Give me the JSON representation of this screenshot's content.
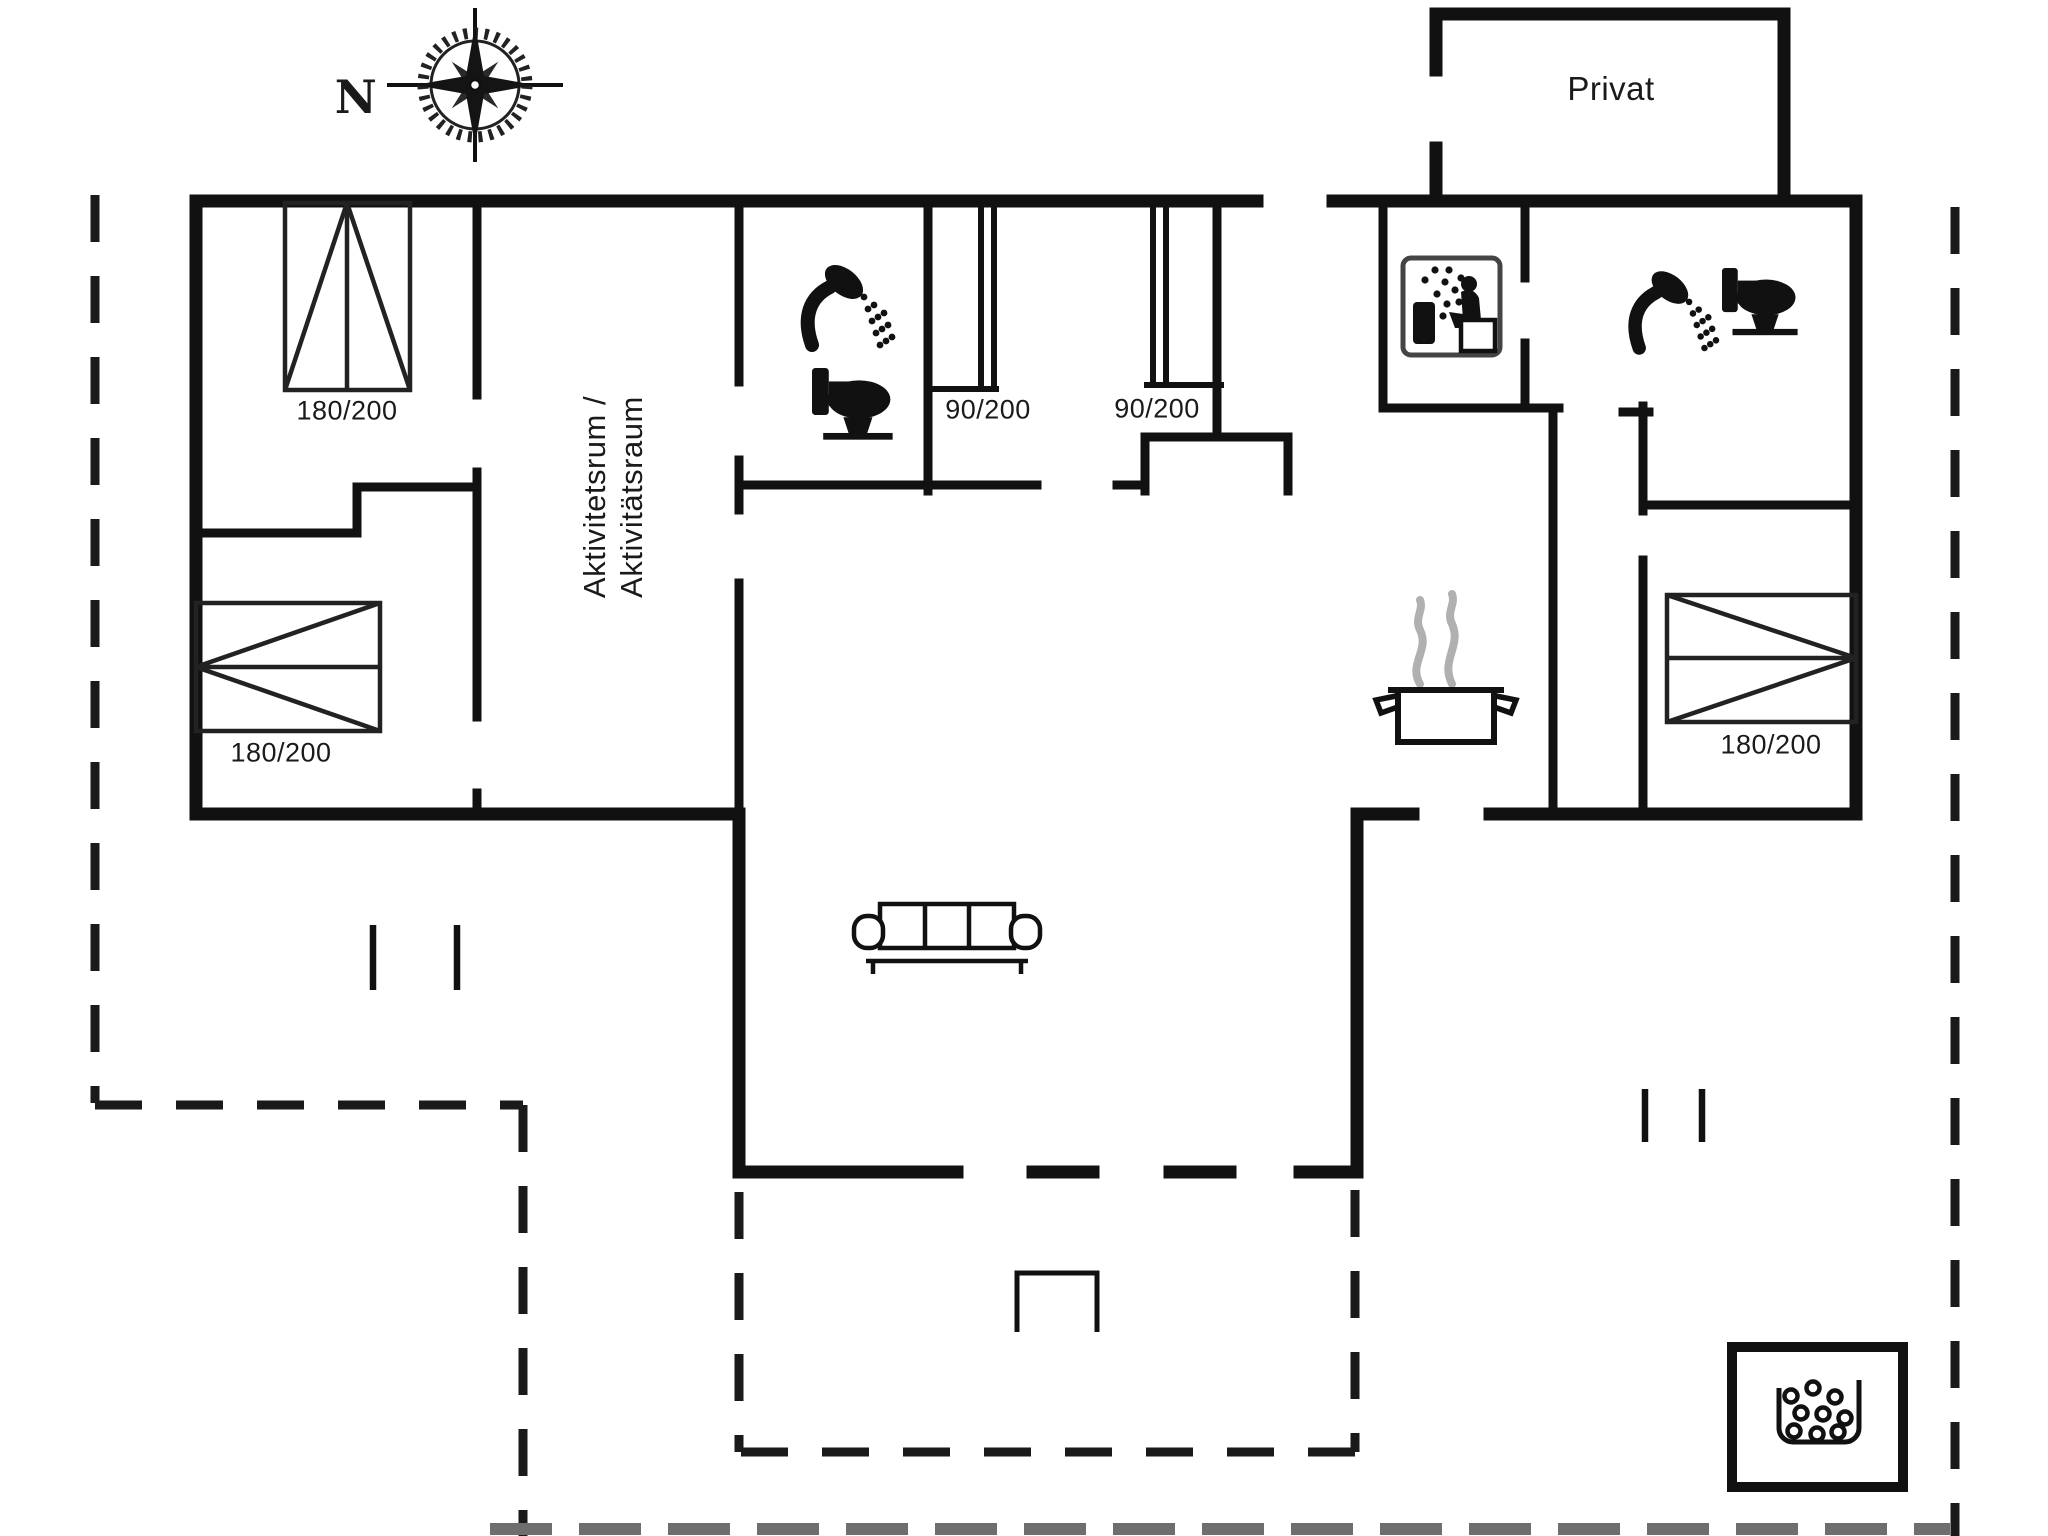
{
  "title": "Holiday house floor plan",
  "compass": {
    "north_label": "N"
  },
  "annex": {
    "label": "Privat"
  },
  "activity_room": {
    "line1": "Aktivitetsrum /",
    "line2": "Aktivitätsraum"
  },
  "bed_labels": {
    "top_left": "180/200",
    "bottom_left": "180/200",
    "right": "180/200",
    "cabin_left": "90/200",
    "cabin_right": "90/200"
  },
  "icons": {
    "compass": "compass-rose-icon",
    "shower": "shower-icon",
    "toilet": "toilet-icon",
    "sauna": "sauna-icon",
    "kitchen": "cooking-pot-icon",
    "sofa": "sofa-icon",
    "terrace_table": "table-icon",
    "washer": "washing-machine-icon"
  },
  "colors": {
    "wall": "#111111",
    "boundary_dash": "#1a1a1a",
    "terrace_dash_gray": "#6e6e6e",
    "steam_gray": "#b0b0b0",
    "background": "#ffffff"
  }
}
